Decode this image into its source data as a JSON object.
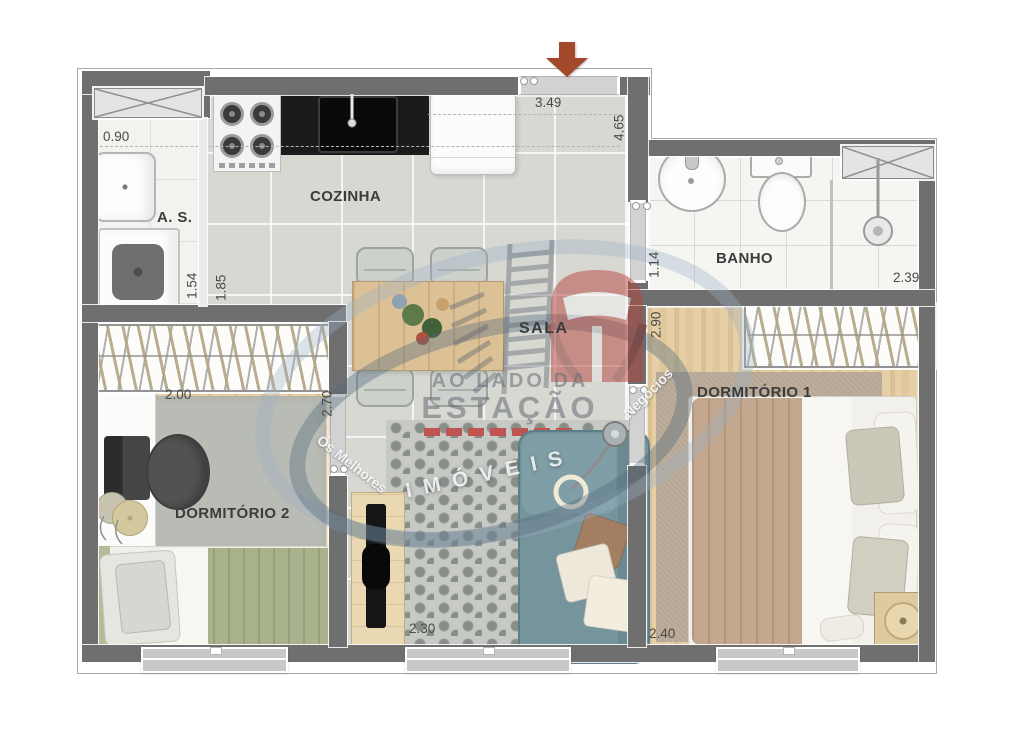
{
  "rooms": {
    "cozinha": {
      "label": "COZINHA"
    },
    "sala": {
      "label": "SALA"
    },
    "banho": {
      "label": "BANHO"
    },
    "dormitorio1": {
      "label": "DORMITÓRIO 1"
    },
    "dormitorio2": {
      "label": "DORMITÓRIO 2"
    },
    "area_servico": {
      "label": "A. S."
    }
  },
  "dimensions": {
    "as_width": "0.90",
    "as_length": "1.54",
    "kitchen_side": "1.85",
    "entry_width": "3.49",
    "kitchen_depth": "4.65",
    "bath_entry": "1.14",
    "bath_width": "2.39",
    "dorm1_depth": "2.90",
    "dorm2_width": "2.00",
    "dorm2_depth": "2.70",
    "sala_width": "2.30",
    "dorm1_width": "2.40"
  },
  "watermark": {
    "brand_line1": "AO LADO DA",
    "brand_line2": "ESTAÇÃO",
    "brand_line3": "IMÓVEIS",
    "tagline_left": "Os Melhores",
    "tagline_right": "Negócios"
  },
  "colors": {
    "wall": "#6f6f6f",
    "entry_arrow": "#a3492b",
    "sofa": "#75949c",
    "dorm1_blanket": "#c3a78e",
    "dorm2_blanket": "#a9b28d",
    "brand_red": "#b5443a",
    "swoosh_blue": "#9bb0c4"
  }
}
